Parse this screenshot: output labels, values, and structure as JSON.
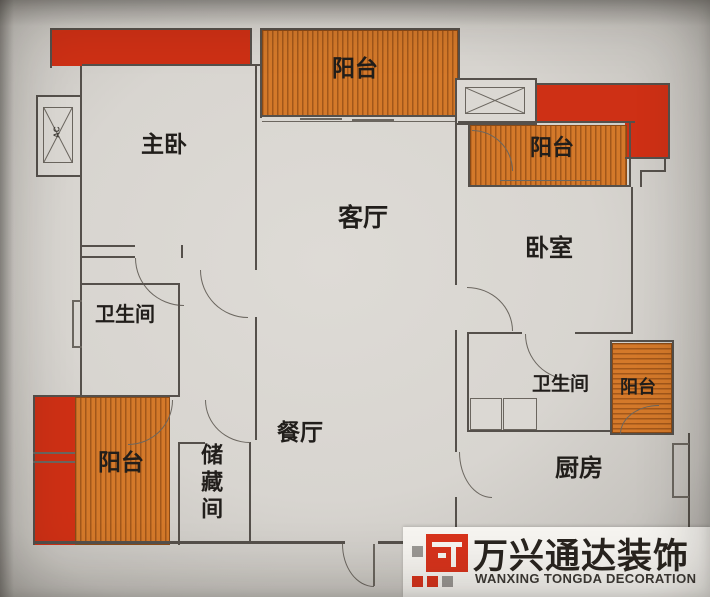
{
  "rooms": {
    "master_bedroom": "主卧",
    "living_room": "客厅",
    "bedroom": "卧室",
    "dining_room": "餐厅",
    "kitchen": "厨房",
    "storage_room": "储藏间",
    "bathroom_left": "卫生间",
    "bathroom_right": "卫生间",
    "balcony_top": "阳台",
    "balcony_top_right": "阳台",
    "balcony_bottom_left": "阳台",
    "balcony_right": "阳台"
  },
  "labels": {
    "ac_unit": "AC"
  },
  "watermark": {
    "company_cn": "万兴通达装饰",
    "company_en": "WANXING TONGDA DECORATION"
  },
  "colors": {
    "balcony_orange": "#d4792a",
    "balcony_stripe": "#a2571a",
    "accent_red": "#ce3015",
    "wall": "#55504b",
    "paper": "#d8d5d0",
    "logo_red": "#d8331c"
  }
}
